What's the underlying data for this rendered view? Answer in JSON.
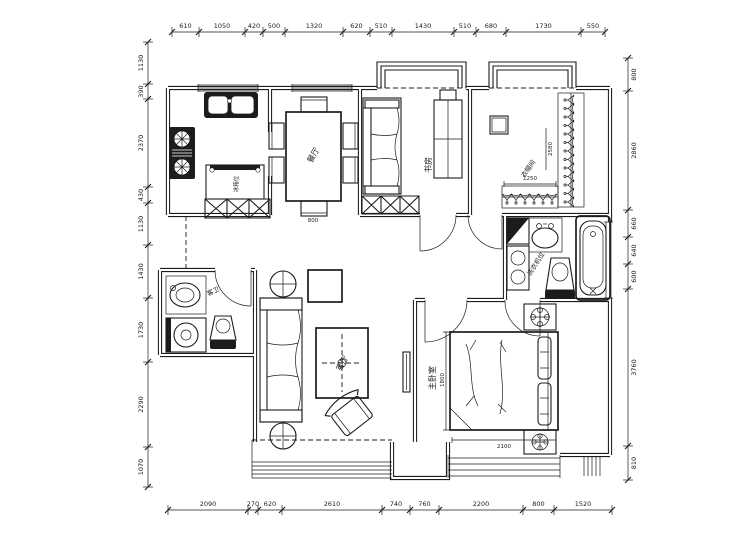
{
  "meta": {
    "drawing_type": "apartment-floor-plan",
    "ink_color": "#1c1c1c",
    "background_color": "#ffffff"
  },
  "rooms": {
    "dining_label": "餐厅",
    "study_label": "书房",
    "closet_label": "衣帽间",
    "living_label": "客厅",
    "master_bedroom_label": "主卧室",
    "guest_bath_label": "客卫",
    "laundry_note": "洗衣机位",
    "fridge_note": "冰箱位"
  },
  "dimensions": {
    "top": [
      "610",
      "1050",
      "420",
      "500",
      "1320",
      "620",
      "510",
      "1430",
      "510",
      "680",
      "1730",
      "550"
    ],
    "bottom": [
      "2090",
      "270",
      "620",
      "2610",
      "740",
      "760",
      "2200",
      "800",
      "1520"
    ],
    "left": [
      "1130",
      "390",
      "2370",
      "430",
      "1130",
      "1430",
      "1730",
      "2290",
      "1070"
    ],
    "right": [
      "800",
      "2860",
      "660",
      "640",
      "600",
      "3760",
      "810"
    ],
    "furniture": {
      "closet_width": "1250",
      "closet_depth": "2580",
      "bed_width": "1800",
      "bed_length": "2100",
      "dining_table": "800"
    }
  }
}
